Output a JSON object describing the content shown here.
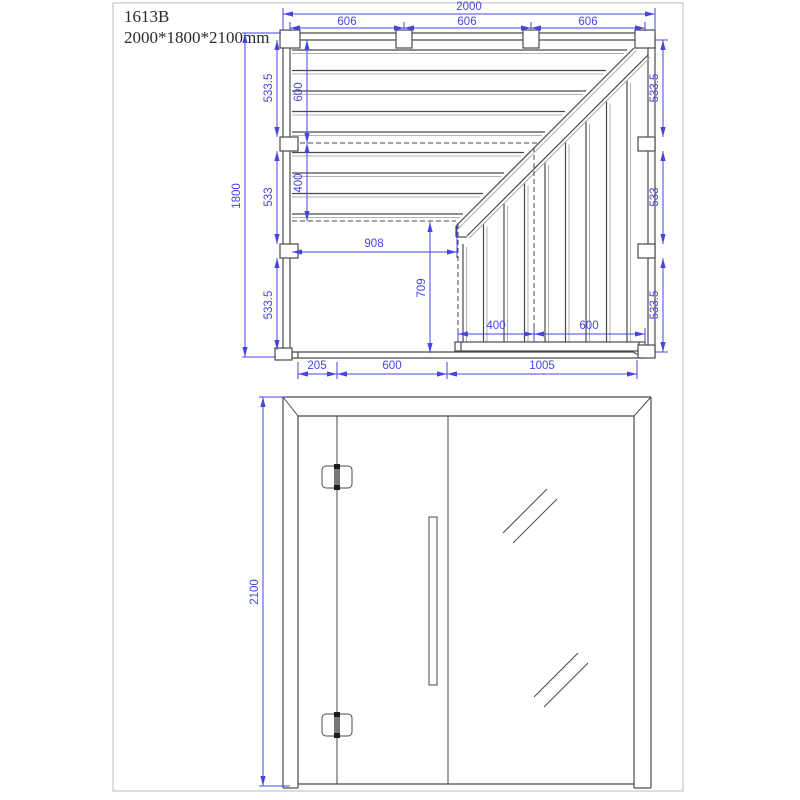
{
  "title": {
    "model": "1613B",
    "size": "2000*1800*2100mm"
  },
  "plan_view": {
    "dim_width_total": "2000",
    "dim_width_segments": [
      "606",
      "606",
      "606"
    ],
    "dim_depth_total": "1800",
    "dim_left_segments": [
      "533.5",
      "533",
      "533.5"
    ],
    "dim_right_segments": [
      "533.5",
      "533",
      "533.5"
    ],
    "dim_bench_depth_upper": "600",
    "dim_bench_depth_lower": "400",
    "dim_floor_width": "908",
    "dim_floor_depth": "709",
    "dim_bench_width_left": "400",
    "dim_bench_width_right": "600",
    "dim_bottom_segments": [
      "205",
      "600",
      "1005"
    ]
  },
  "front_view": {
    "dim_height_total": "2100"
  },
  "colors": {
    "dimension_blue": "#4545df",
    "drawing_line": "#4a4a4a"
  }
}
